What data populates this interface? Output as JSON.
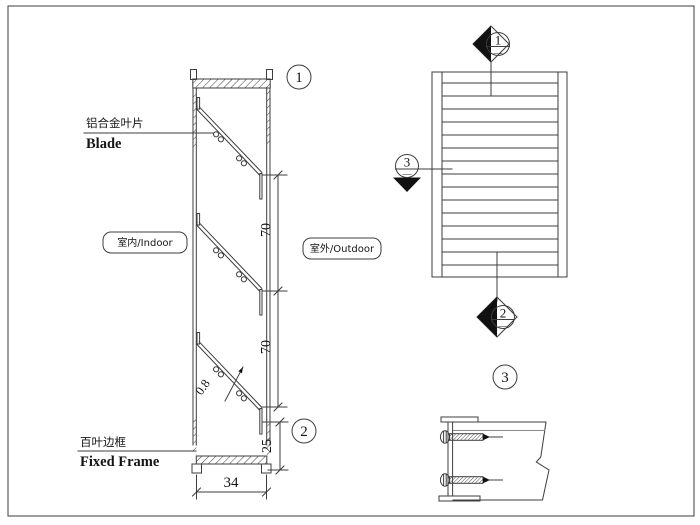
{
  "colors": {
    "line": "#3d3d3d",
    "text": "#141414",
    "background": "#ffffff",
    "marker_fill": "#111111",
    "flange_fill": "#cccccc"
  },
  "section_view": {
    "balloon_top": "1",
    "balloon_bottom": "2",
    "blade_label_cn": "铝合金叶片",
    "blade_label_en": "Blade",
    "frame_label_cn": "百叶边框",
    "frame_label_en": "Fixed Frame",
    "indoor_tag": "室内/Indoor",
    "outdoor_tag": "室外/Outdoor",
    "blade_count": 3,
    "dims": {
      "pitch_upper": "70",
      "pitch_lower": "70",
      "thickness": "0.8",
      "bottom_height": "25",
      "depth": "34"
    }
  },
  "elevation_view": {
    "slat_count": 13,
    "marker_top": {
      "number": "1",
      "sheet": "—"
    },
    "marker_left": {
      "number": "3",
      "sheet": "—"
    },
    "marker_bottom": {
      "number": "2",
      "sheet": "—"
    }
  },
  "detail_view": {
    "balloon": "3",
    "screw_count": 2
  }
}
